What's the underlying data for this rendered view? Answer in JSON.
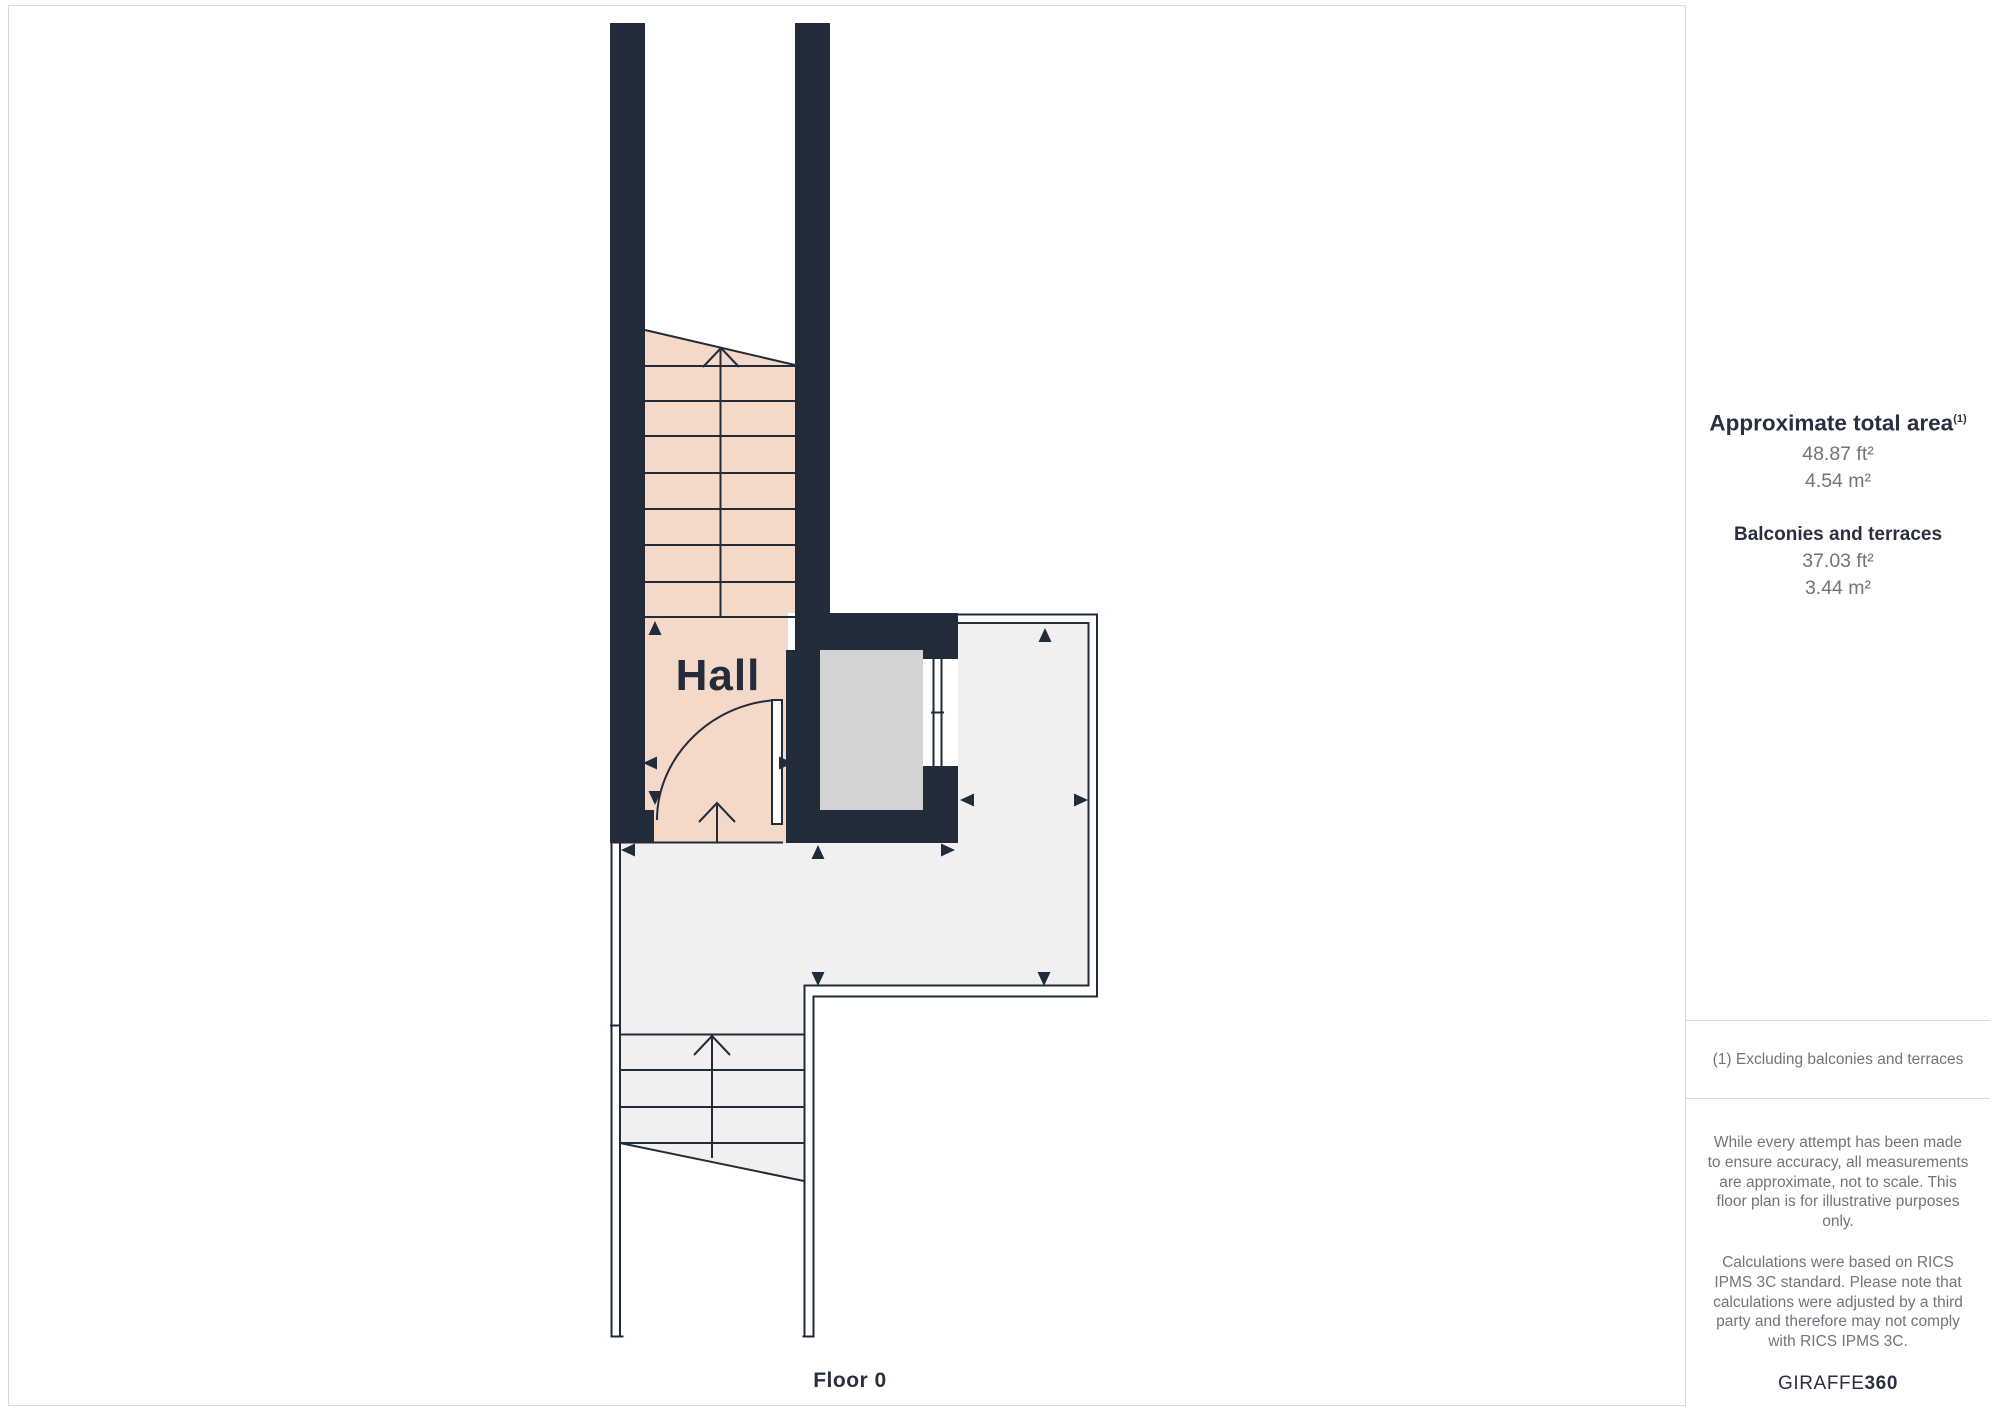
{
  "page": {
    "border_color": "#dbdbdb"
  },
  "plan": {
    "room_label": "Hall",
    "floor_label": "Floor 0",
    "colors": {
      "wall": "#212b3a",
      "line": "#222b3a",
      "text": "#242b3a",
      "hall_floor": "#f4d9c8",
      "elevator_floor": "#d3d3d3",
      "terrace_floor": "#f0f0f1",
      "door_leaf": "#ffffff"
    }
  },
  "sidebar": {
    "total_area": {
      "title": "Approximate total area",
      "footnote_marker": "(1)",
      "value_ft": "48.87 ft²",
      "value_m": "4.54 m²"
    },
    "balconies": {
      "title": "Balconies and terraces",
      "value_ft": "37.03 ft²",
      "value_m": "3.44 m²"
    },
    "footnote": "(1) Excluding balconies and terraces",
    "disclaimer_p1": "While every attempt has been made to ensure accuracy, all measurements are approximate, not to scale. This floor plan is for illustrative purposes only.",
    "disclaimer_p2": "Calculations were based on RICS IPMS 3C standard. Please note that calculations were adjusted by a third party and therefore may not comply with RICS IPMS 3C.",
    "brand_name": "GIRAFFE",
    "brand_suffix": "360"
  }
}
